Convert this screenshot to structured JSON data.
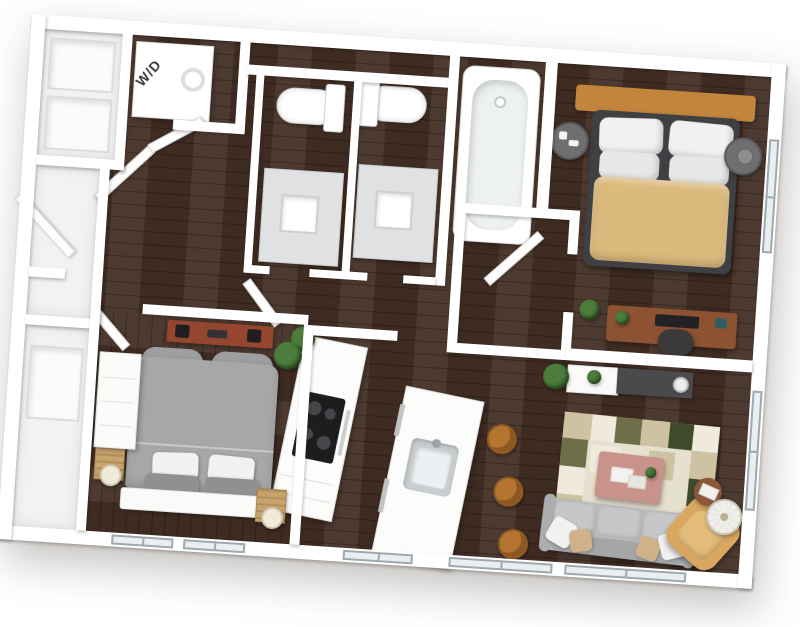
{
  "floorplan": {
    "appliance_labels": {
      "washer_dryer": "W/D"
    },
    "colors": {
      "wall": "#ffffff",
      "floor": "#432f25",
      "glass": "#e9eef1",
      "frame": "#9fa8ad",
      "master_duvet": "#dcba7d",
      "master_headboard": "#c3853b",
      "bed_base": "#3f4043",
      "pillow": "#f1f1ef",
      "nightstand": "#6f6f71",
      "desk": "#8d5232",
      "chair_dark": "#3a3a3a",
      "console_dark": "#4a4a4c",
      "rug_base": "#e6e0cf",
      "rug_tan": "#cdc3a2",
      "rug_olive": "#6e6f49",
      "rug_dark": "#3f4a2b",
      "rug_cream": "#efeadb",
      "coffee_table": "#c9928a",
      "sofa": "#b9babb",
      "sofa_cushion": "#c6c7c8",
      "pillow_tan": "#cfb289",
      "armchair": "#d9a75f",
      "armchair_seat": "#e4bc7a",
      "stool": "#b5742f",
      "plant": "#4c7d3c",
      "plant_dark": "#2f5a28",
      "vanity": "#dfe1e2",
      "bed2_duvet": "#a7a7a8",
      "bed2_pillow_gray": "#8f9092",
      "crate": "#c8a46c",
      "shelf_wood": "#94462e",
      "cooktop": "#1d1d1f"
    }
  }
}
